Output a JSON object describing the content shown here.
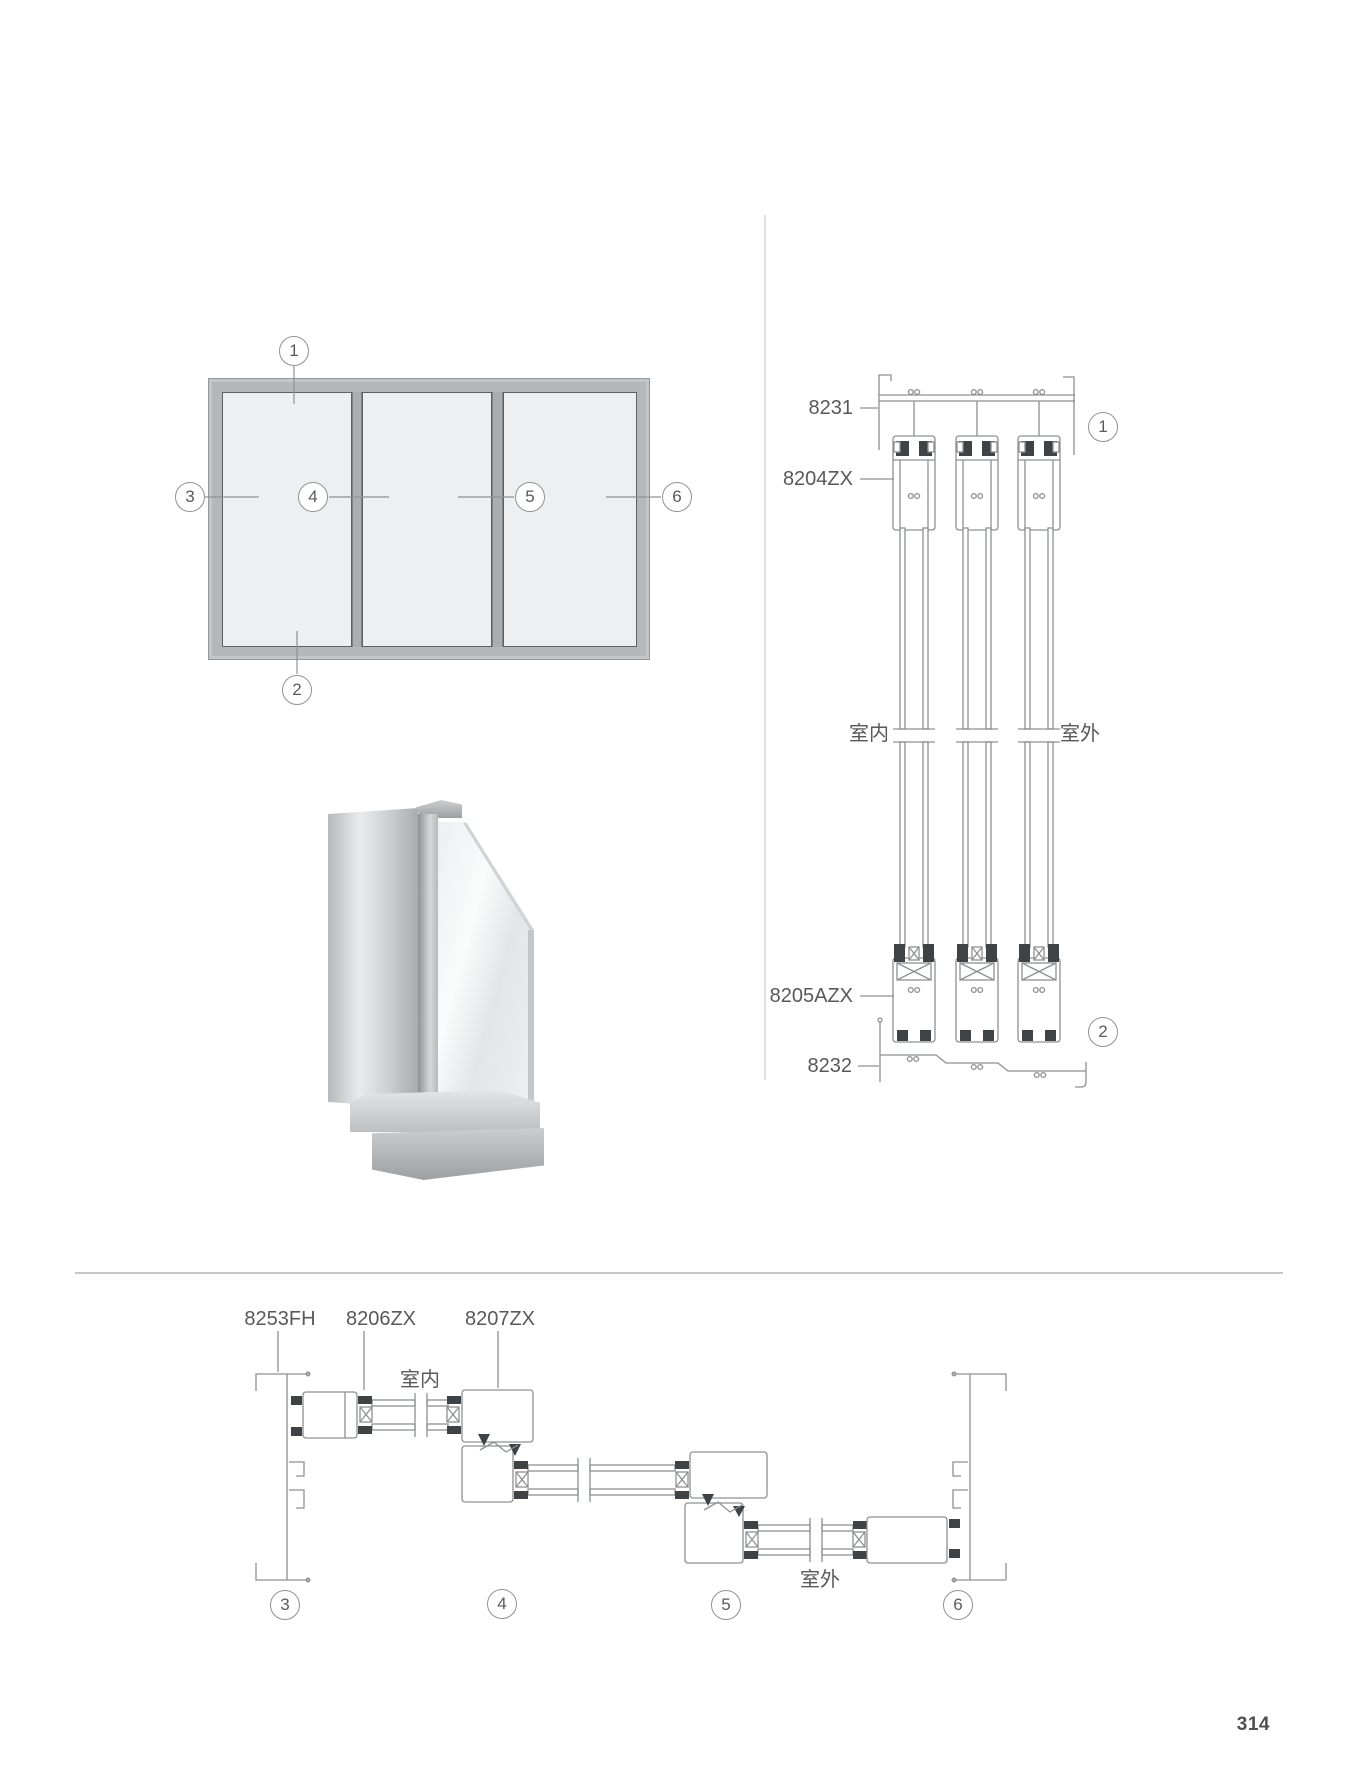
{
  "page": {
    "number": "314"
  },
  "elevation": {
    "callouts": [
      "1",
      "2",
      "3",
      "4",
      "5",
      "6"
    ]
  },
  "vertical_section": {
    "labels": {
      "top_frame": "8231",
      "sash_top": "8204ZX",
      "sash_bottom": "8205AZX",
      "bottom_frame": "8232"
    },
    "indoor": "室内",
    "outdoor": "室外",
    "callouts": [
      "1",
      "2"
    ]
  },
  "horizontal_section": {
    "labels": {
      "side_frame": "8253FH",
      "sash": "8206ZX",
      "interlock": "8207ZX"
    },
    "indoor": "室内",
    "outdoor": "室外",
    "callouts": [
      "3",
      "4",
      "5",
      "6"
    ]
  },
  "colors": {
    "line": "#8d9092",
    "seal": "#404346",
    "text": "#58595b",
    "frame_fill": "#b5b8ba",
    "glass_fill": "#edeff0"
  }
}
